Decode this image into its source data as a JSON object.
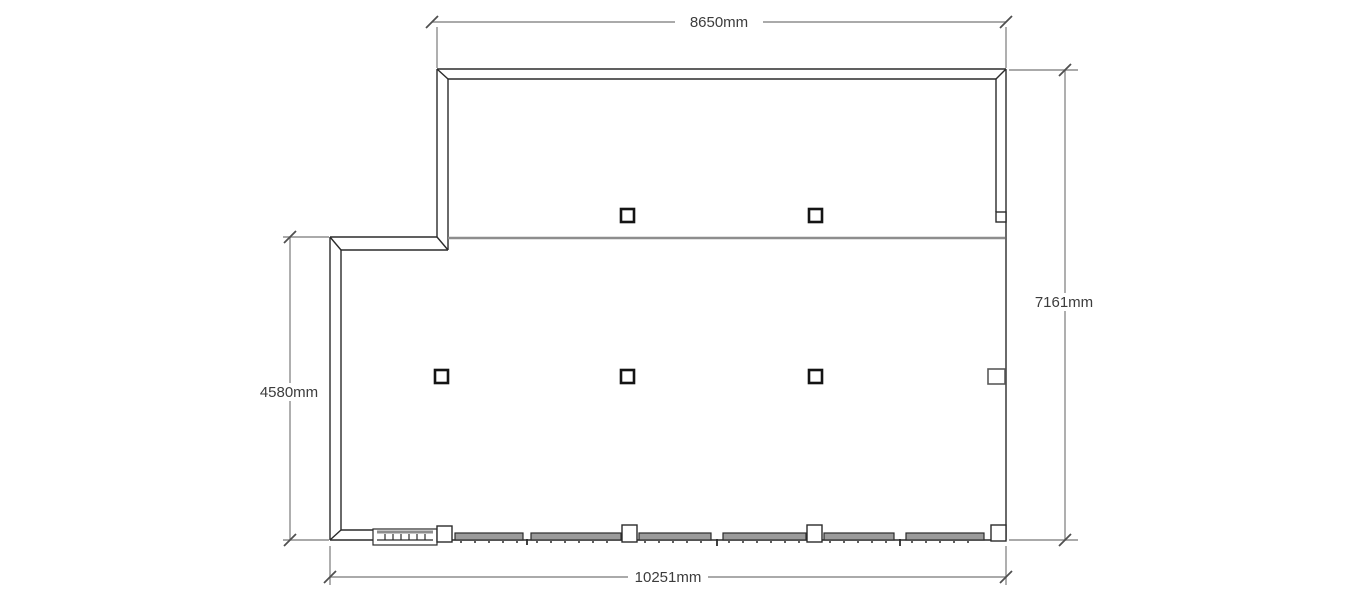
{
  "plan": {
    "dimensions": {
      "top": {
        "label": "8650mm"
      },
      "right": {
        "label": "7161mm"
      },
      "left": {
        "label": "4580mm"
      },
      "bottom": {
        "label": "10251mm"
      }
    }
  },
  "colors": {
    "background": "#ffffff",
    "wall_line": "#2b2b2b",
    "dimension_line": "#8d8d8d",
    "dimension_tick": "#4f4f4f",
    "dimension_text": "#3c3c3c",
    "divider_line": "#8d8d8d",
    "glazing_fill": "#9b9b9b",
    "column_stroke": "#141414",
    "pilaster_stroke": "#5a5a5a"
  }
}
